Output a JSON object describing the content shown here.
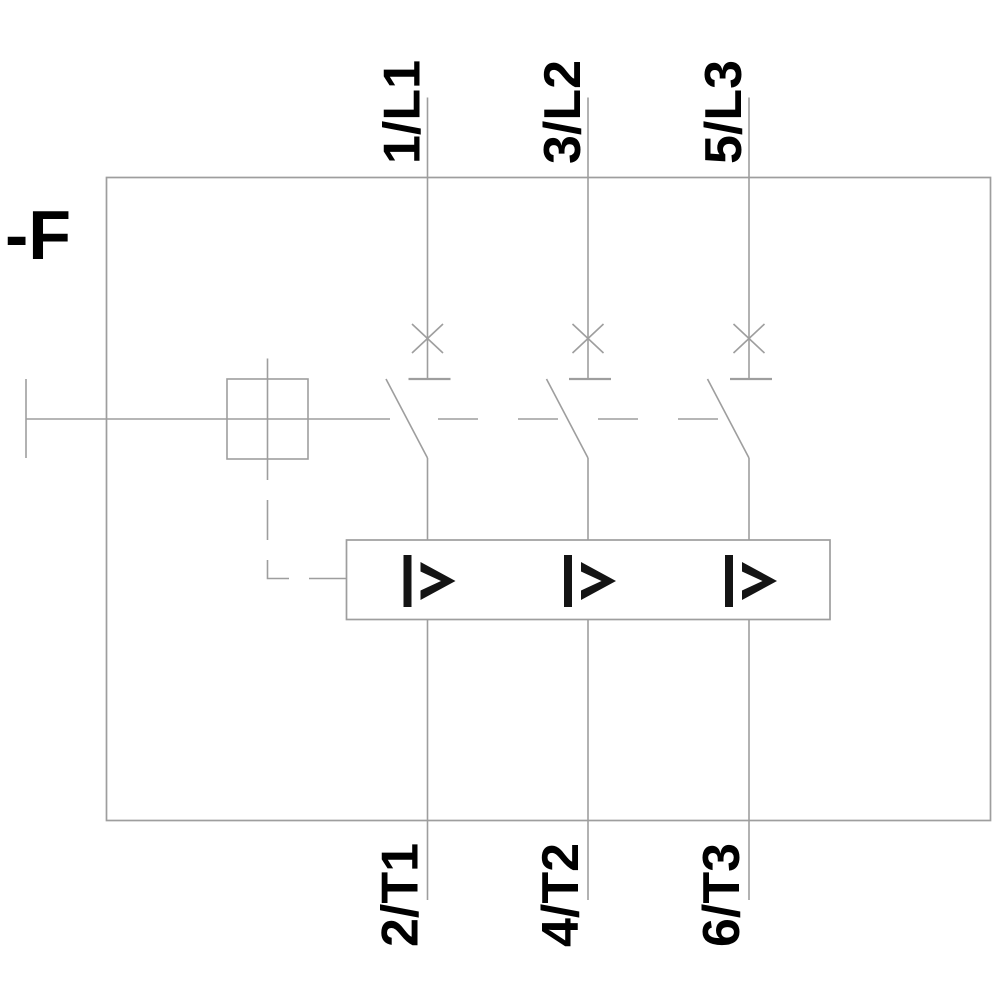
{
  "diagram": {
    "type": "circuit-breaker-schematic",
    "device_label": "-F",
    "overload_release_symbol": "I>",
    "poles": [
      {
        "top_terminal": "1/L1",
        "bottom_terminal": "2/T1"
      },
      {
        "top_terminal": "3/L2",
        "bottom_terminal": "4/T2"
      },
      {
        "top_terminal": "5/L3",
        "bottom_terminal": "6/T3"
      }
    ],
    "colors": {
      "line": "#9e9e9e",
      "text": "#000000",
      "background": "#ffffff"
    }
  }
}
